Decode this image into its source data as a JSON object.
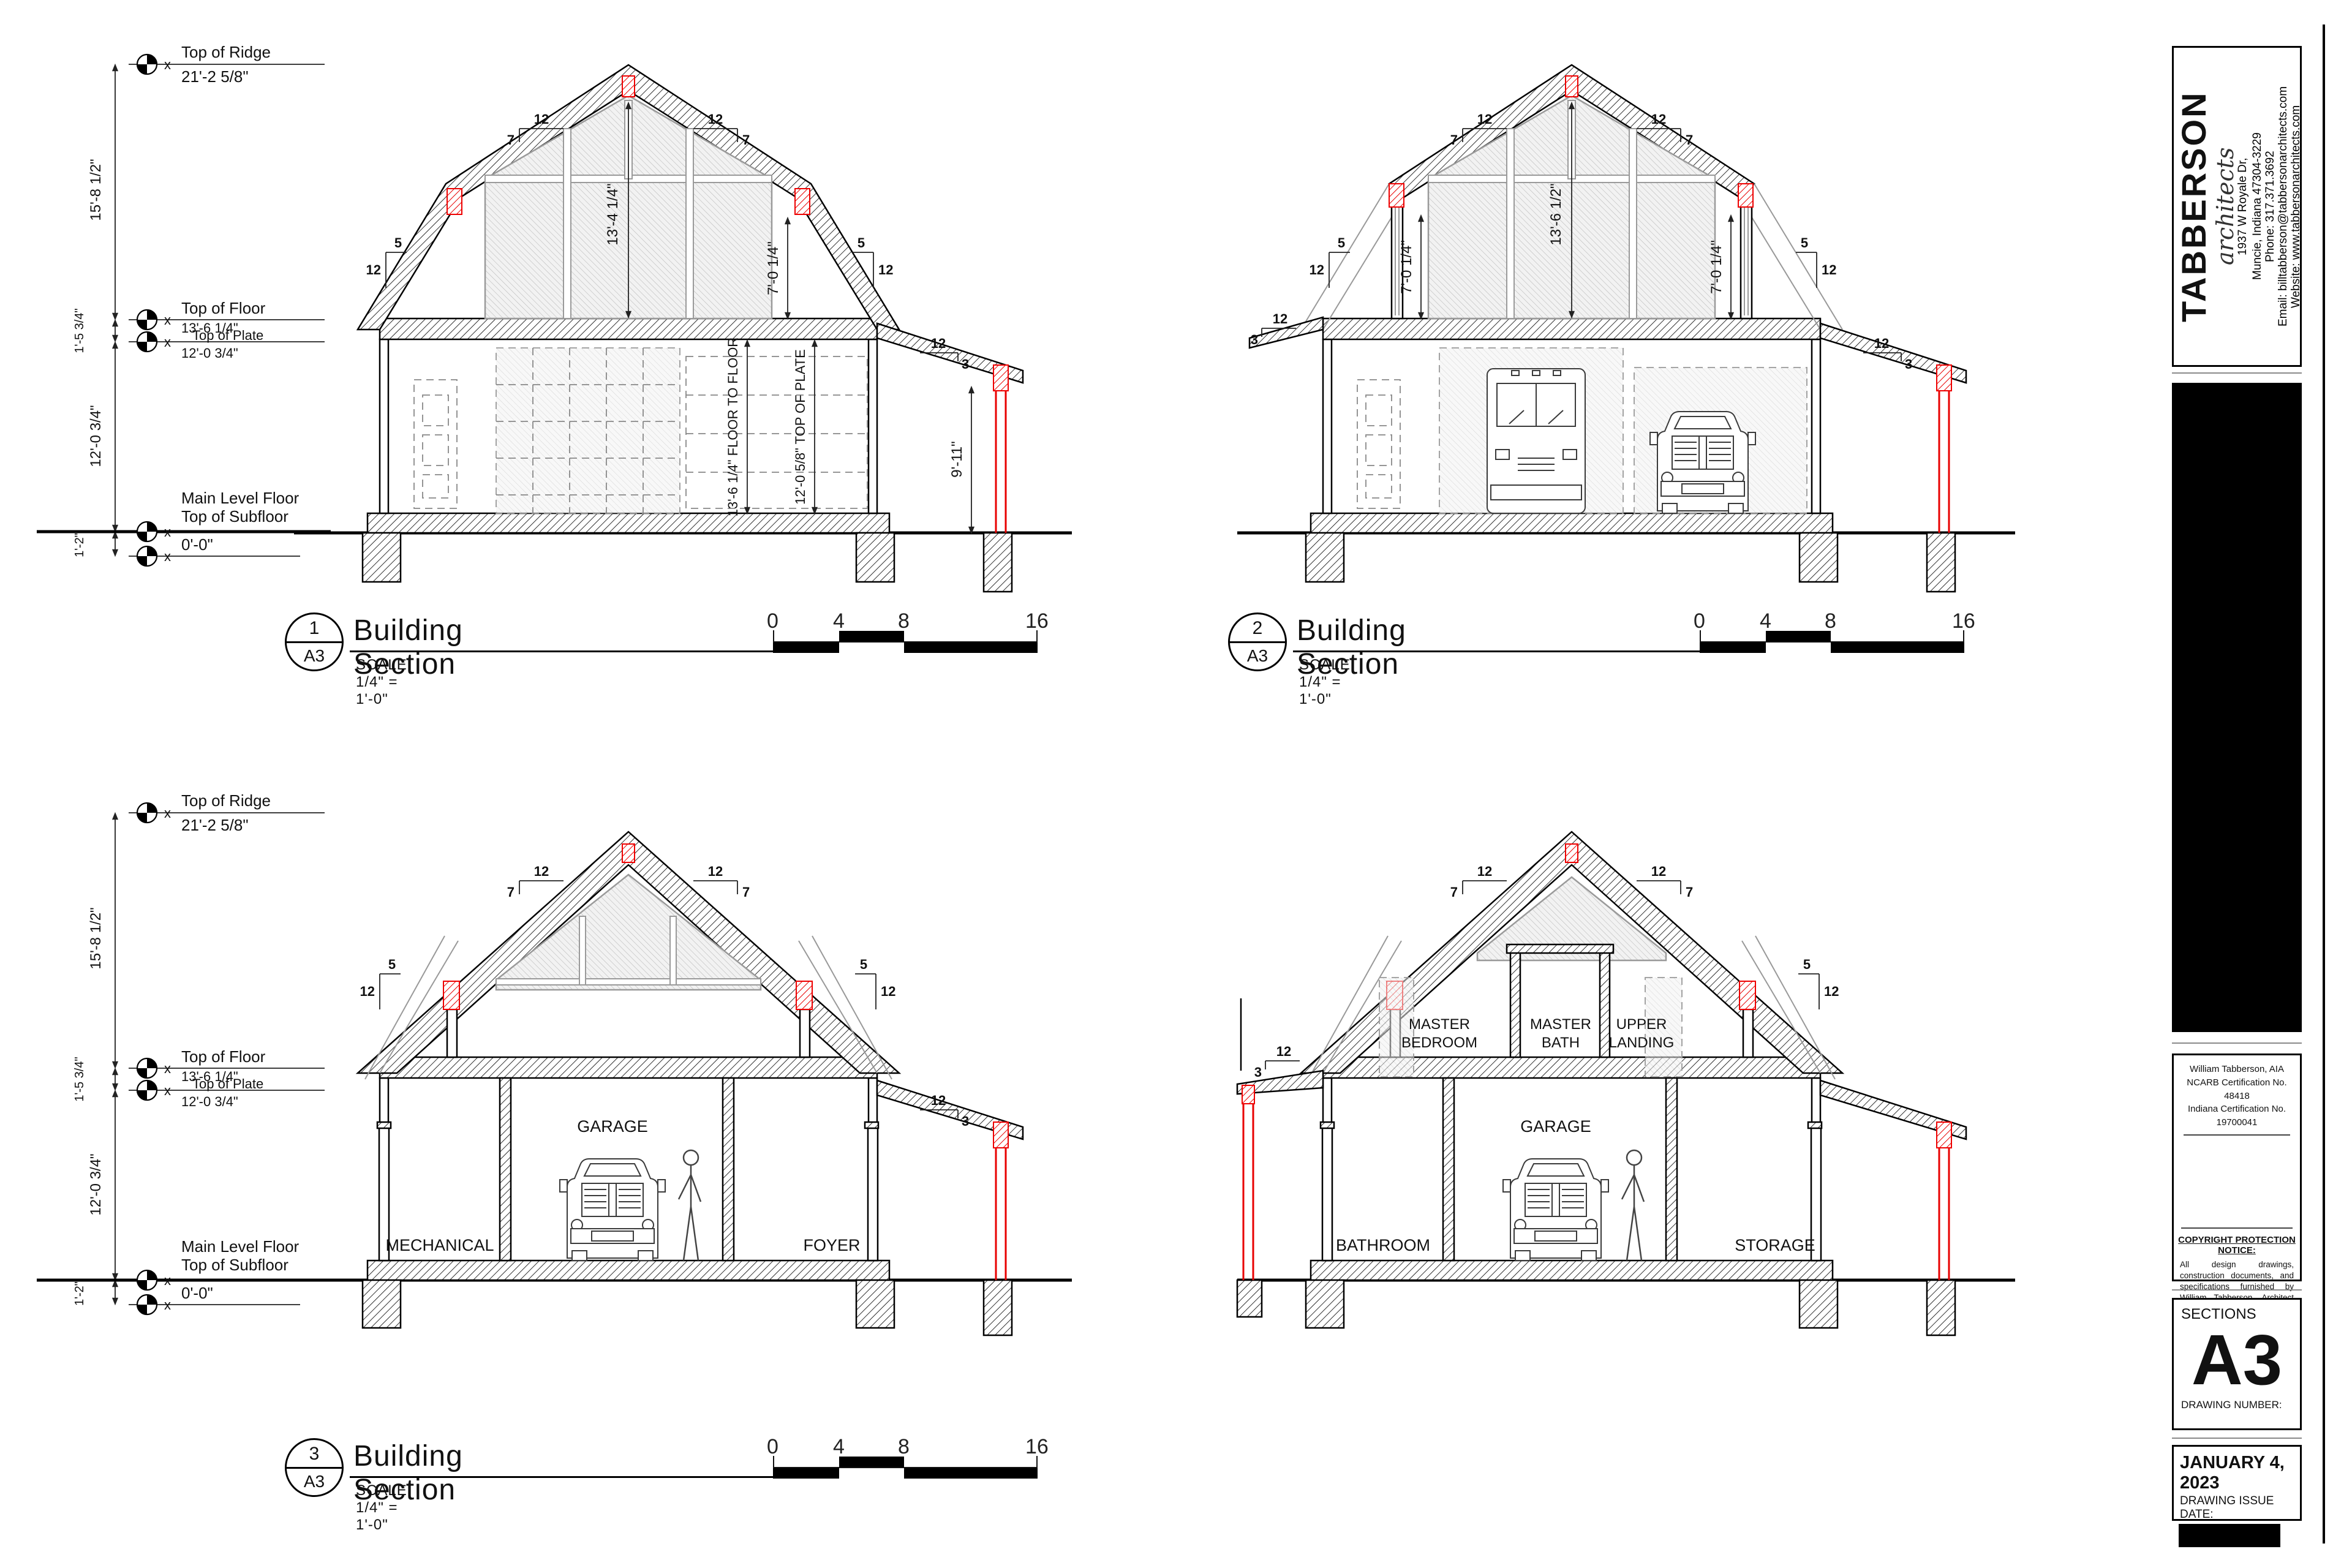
{
  "levels": {
    "top_of_ridge_label": "Top of Ridge",
    "top_of_ridge_value": "21'-2 5/8\"",
    "top_of_floor_label": "Top of Floor",
    "top_of_floor_value": "13'-6 1/4\"",
    "top_of_plate_label": "Top of Plate",
    "top_of_plate_value": "12'-0 3/4\"",
    "main_level_label1": "Main Level Floor",
    "main_level_label2": "Top of Subfloor",
    "main_level_value": "0'-0\"",
    "dim_ridge": "15'-8 1/2\"",
    "dim_floor_plate": "1'-5 3/4\"",
    "dim_plate_sub": "12'-0 3/4\"",
    "dim_footing": "1'-2\""
  },
  "titles": {
    "s1_num": "1",
    "s2_num": "2",
    "s3_num": "3",
    "sheet_ref": "A3",
    "title": "Building Section",
    "scale": "SCALE: 1/4\" = 1'-0\"",
    "bar_ticks": [
      "0",
      "4",
      "8",
      "16"
    ]
  },
  "dims": {
    "slope_12": "12",
    "slope_7": "7",
    "slope_5": "5",
    "slope_3": "3",
    "attic_s1": "13'-4 1/4\"",
    "attic_s2": "13'-6 1/2\"",
    "knee": "7'-0 1/4\"",
    "post": "9'-11\"",
    "floor_to_floor": "13'-6 1/4\" FLOOR TO FLOOR",
    "top_plate": "12'-0 5/8\" TOP OF PLATE"
  },
  "rooms": {
    "mechanical": "MECHANICAL",
    "garage": "GARAGE",
    "foyer": "FOYER",
    "bathroom": "BATHROOM",
    "storage": "STORAGE",
    "master_bedroom1": "MASTER",
    "master_bedroom2": "BEDROOM",
    "master_bath1": "MASTER",
    "master_bath2": "BATH",
    "upper_landing1": "UPPER",
    "upper_landing2": "LANDING"
  },
  "titleblock": {
    "brand": "TABBERSON",
    "brand_sub": "architects",
    "address1": "1937 W Royale Dr,",
    "address2": "Muncie, Indiana 47304-3229",
    "phone": "Phone:  317.371.3692",
    "email": "Email: billtabberson@tabbersonarchitects.com",
    "website": "Website: www.tabbersonarchitects.com",
    "cert1": "William Tabberson, AIA",
    "cert2": "NCARB Certification No. 48418",
    "cert3": "Indiana Certification No. 19700041",
    "copyright_title": "COPYRIGHT PROTECTION NOTICE:",
    "copyright_body": "All design drawings, construction documents, and specifications furnished by William Tabberson, Architect are and shall remain the property of the Architects. They are to be used only for the construction of this project.",
    "sheet_name": "SECTIONS",
    "sheet_number": "A3",
    "drawing_number_label": "DRAWING NUMBER:",
    "issue_date": "JANUARY 4, 2023",
    "issue_date_label": "DRAWING ISSUE DATE:"
  }
}
